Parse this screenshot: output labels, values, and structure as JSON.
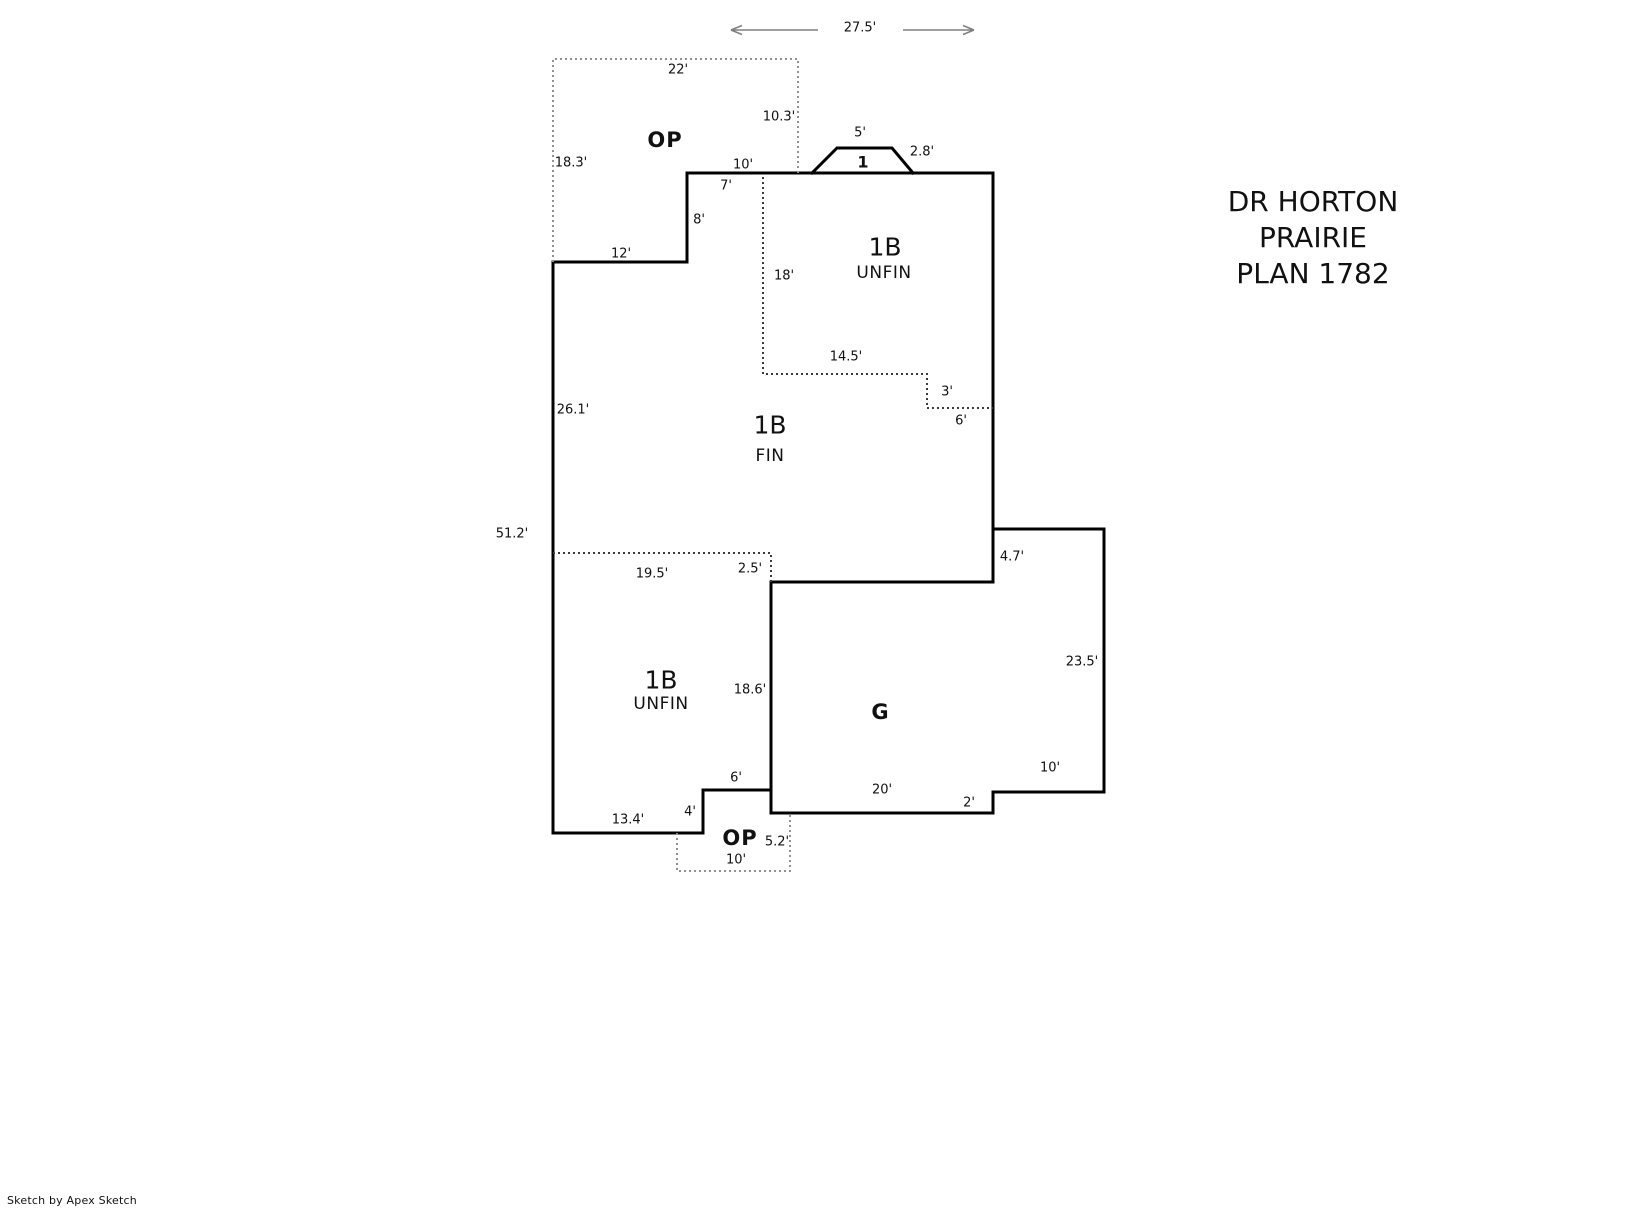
{
  "title": {
    "line1": "DR HORTON",
    "line2": "PRAIRIE",
    "line3": "PLAN 1782"
  },
  "watermark": "Sketch by Apex Sketch",
  "rooms": {
    "porch_top_label": "OP",
    "story_marker": "1",
    "basement_unfin_upper": {
      "code": "1B",
      "status": "UNFIN"
    },
    "basement_fin": {
      "code": "1B",
      "status": "FIN"
    },
    "basement_unfin_lower": {
      "code": "1B",
      "status": "UNFIN"
    },
    "garage_label": "G",
    "porch_bottom_label": "OP"
  },
  "dimensions": {
    "overall_width": "27.5'",
    "porch_top_width": "22'",
    "porch_top_left": "18.3'",
    "porch_top_right": "10.3'",
    "entry_top": "10'",
    "stoop_top": "5'",
    "stoop_side": "2.8'",
    "fin_top_wall": "7'",
    "step_left": "8'",
    "ledge_bottom": "12'",
    "unfin_upper_left": "18'",
    "unfin_upper_bottom": "14.5'",
    "unfin_upper_jog_side": "3'",
    "unfin_upper_jog_bottom": "6'",
    "fin_left_wall": "26.1'",
    "overall_left_wall": "51.2'",
    "fin_bottom": "19.5'",
    "fin_bottom_jog": "2.5'",
    "garage_top_offset": "4.7'",
    "garage_right_wall": "23.5'",
    "unfin_lower_right": "18.6'",
    "bay_top": "6'",
    "bay_side": "4'",
    "unfin_lower_bottom": "13.4'",
    "garage_bottom": "20'",
    "garage_step_side": "2'",
    "garage_ext_bottom": "10'",
    "porch_bottom_right": "5.2'",
    "porch_bottom_width": "10'"
  },
  "colors": {
    "wall": "#000000",
    "interior_dotted": "#3a3a3a",
    "porch_dotted": "#909090",
    "dim_line": "#808080",
    "text": "#111111"
  }
}
